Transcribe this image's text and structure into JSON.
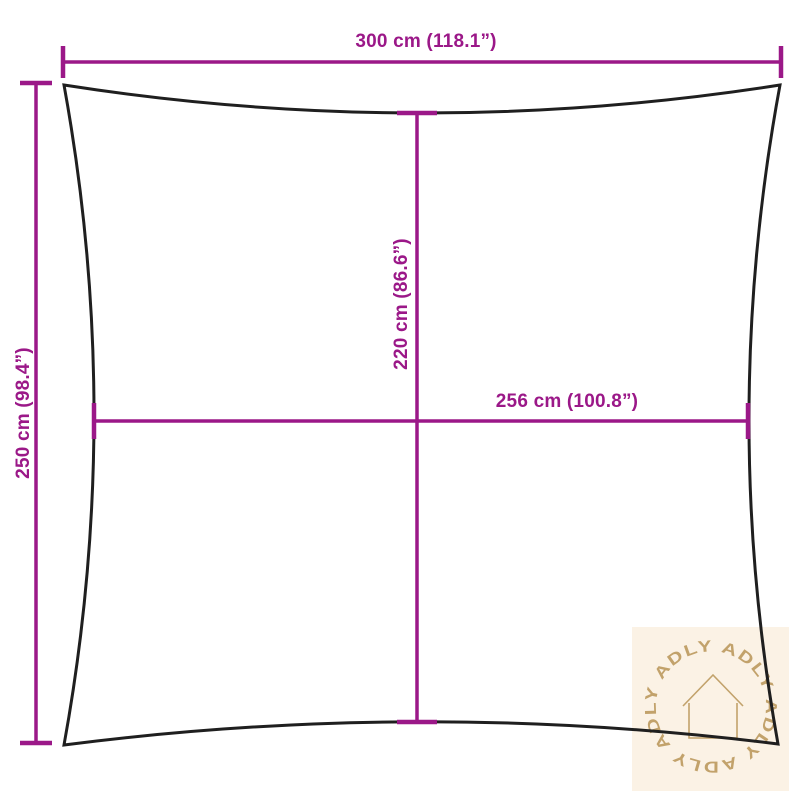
{
  "diagram": {
    "title": "shade-sail-dimension-diagram",
    "dimensions": {
      "overall_width": {
        "label": "300 cm (118.1”)"
      },
      "overall_height": {
        "label": "250 cm (98.4”)"
      },
      "inner_height": {
        "label": "220 cm (86.6”)"
      },
      "inner_width": {
        "label": "256 cm (100.8”)"
      }
    },
    "colors": {
      "dimension_accent": "#9B1888",
      "sail_outline": "#1F1F1F",
      "watermark_background": "#FBF2E5",
      "watermark_foreground": "#C2A26B",
      "page_background": "#FFFFFF"
    },
    "watermark": {
      "brand": "ADLY",
      "circle_text": "ADLY  ADLY  ADLY  ADLY  ADLY",
      "icon": "house-outline-icon"
    }
  }
}
